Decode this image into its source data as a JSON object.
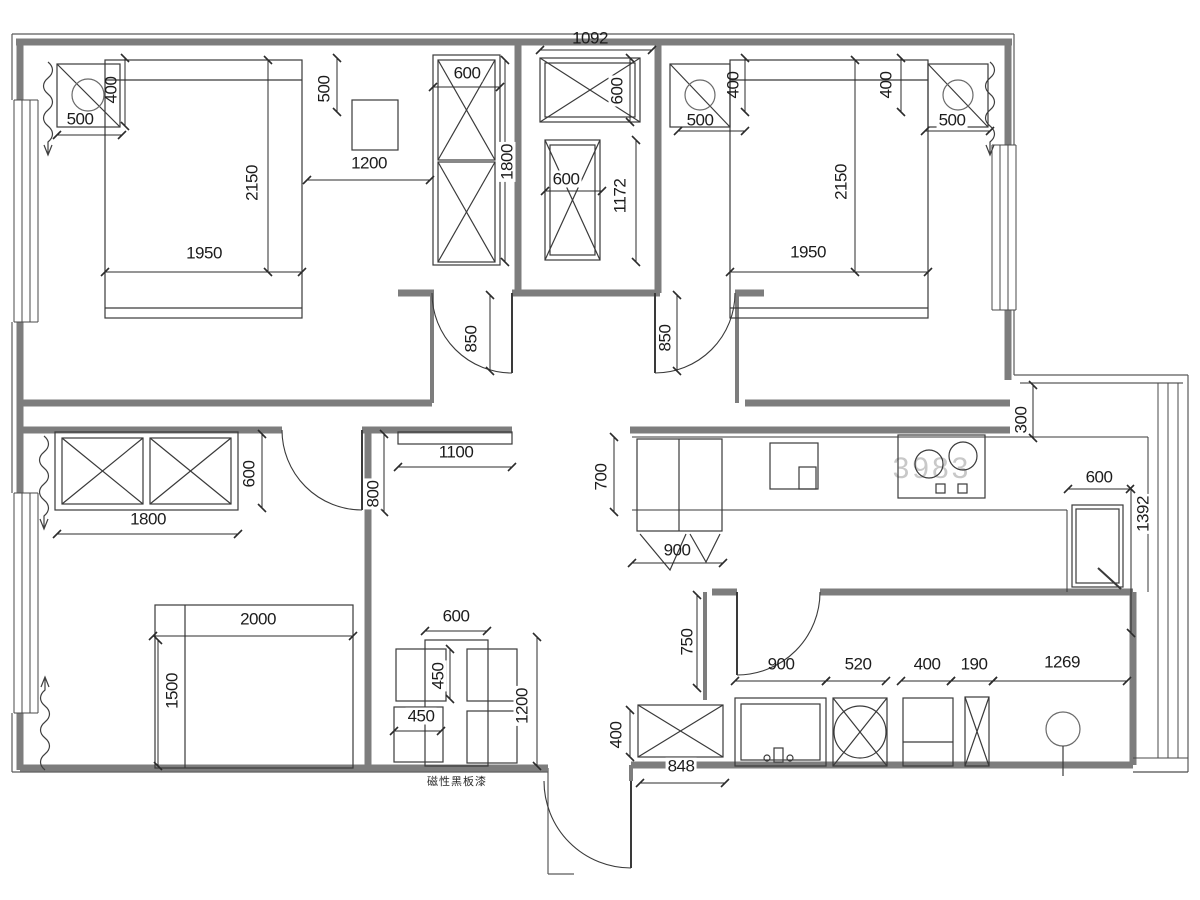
{
  "drawing": {
    "annotations": {
      "wall_note": "磁性黑板漆",
      "watermark": "3983"
    },
    "dims": {
      "tl_nightstand_depth": "400",
      "tl_nightstand_width": "500",
      "tl_bed_length": "2150",
      "tl_bed_width": "1950",
      "tl_desk_offset": "500",
      "tl_desk_width": "1200",
      "tl_wardrobe_width": "600",
      "tl_wardrobe_height": "1800",
      "closet_width": "1092",
      "closet_box_depth": "600",
      "closet_box_width": "600",
      "closet_box_height": "1172",
      "tr_nightstand_left_depth": "400",
      "tr_nightstand_left_width": "500",
      "tr_nightstand_right_depth": "400",
      "tr_nightstand_right_width": "500",
      "tr_bed_length": "2150",
      "tr_bed_width": "1950",
      "door_bedroom_left": "850",
      "door_bedroom_right": "850",
      "hall_shelf_width": "1100",
      "door_bedroom3": "800",
      "b3_wardrobe_depth": "600",
      "b3_wardrobe_width": "1800",
      "b3_bed_width": "2000",
      "b3_bed_length": "1500",
      "dining_table_width": "600",
      "dining_chair_depth": "450",
      "dining_chair_width": "450",
      "dining_zone_length": "1200",
      "kitchen_counter_depth": "700",
      "kitchen_sink_width": "900",
      "kitchen_wall_gap": "300",
      "fridge_width": "600",
      "kitchen_right_length": "1392",
      "bath_wall_length": "750",
      "bath_vanity_width": "900",
      "bath_washer_width": "520",
      "bath_cabinet_width": "400",
      "bath_shelf_width": "190",
      "bath_toilet_zone": "1269",
      "shoe_cabinet_depth": "400",
      "shoe_cabinet_width": "848"
    }
  }
}
